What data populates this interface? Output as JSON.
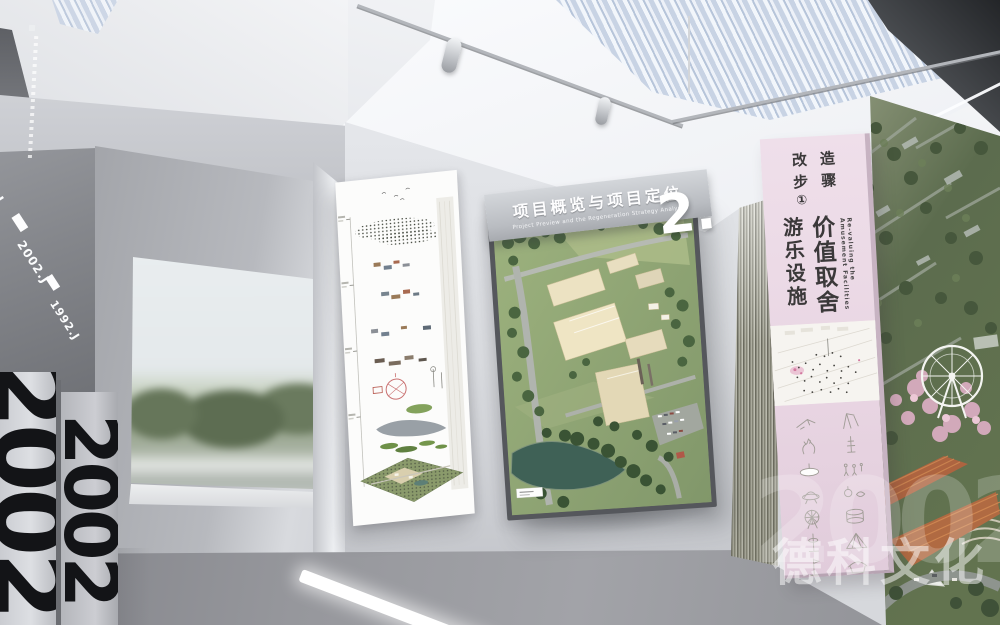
{
  "left_wall": {
    "diagonal_labels": {
      "top": ".BJ",
      "middle": "2002.J",
      "bottom": "1992.J"
    },
    "pillar_number": "2002"
  },
  "header_sign": {
    "title_zh": "项目概览与项目定位",
    "title_en": "Project Preview and the Regeneration Strategy Analysis",
    "section_number": "2."
  },
  "pink_banner": {
    "panel_color": "#ecdce7",
    "step": {
      "c1": "改",
      "c2": "造",
      "c3": "步",
      "c4": "骤",
      "c5": "①"
    },
    "phrase_left": "游乐设施",
    "phrase_right": "价值取舍",
    "english_caption": "Re-valuing the Amusement Facilities",
    "icon_names": [
      "kite-icon",
      "swing-flag-icon",
      "horse-head-icon",
      "signal-tower-icon",
      "disc-ride-icon",
      "figures-icon",
      "saucer-ride-icon",
      "spinner-fish-icon",
      "ferris-wheel-icon",
      "drum-carousel-icon",
      "drop-tower-icon",
      "pyramid-tent-icon",
      "flag-pole-icon",
      "canopy-tent-icon"
    ]
  },
  "watermark": {
    "number": "2002",
    "brand": "德科文化"
  },
  "palette": {
    "wall": "#d6d8dc",
    "floor": "#97989d",
    "skylight_blue": "#c8d3e4",
    "frame": "#55575c",
    "mural_green": "#5c6c4e",
    "accent_pink": "#ecdce7"
  }
}
